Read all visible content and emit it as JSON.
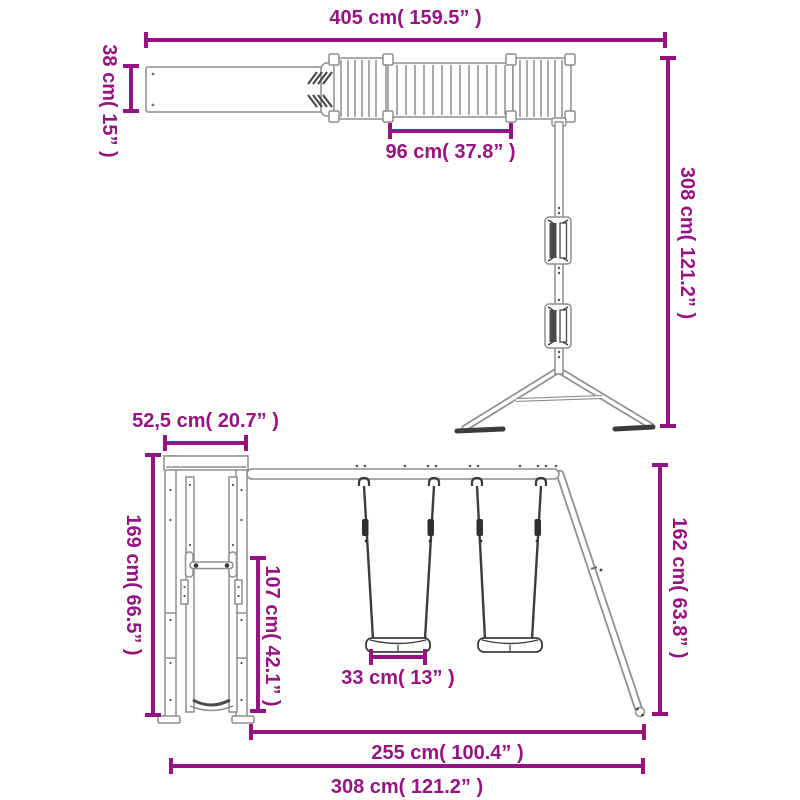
{
  "colors": {
    "dimension_accent": "#961482",
    "structure_line": "#8e8e8e",
    "structure_dark": "#3c3c3c",
    "background": "#ffffff"
  },
  "top_view": {
    "dimensions": {
      "total_length": "405 cm( 159.5” )",
      "platform_depth": "38 cm( 15” )",
      "bridge_length": "96 cm( 37.8” )",
      "frame_depth": "308 cm( 121.2” )"
    }
  },
  "front_view": {
    "dimensions": {
      "tower_width": "52,5 cm( 20.7” )",
      "tower_height": "169 cm( 66.5” )",
      "slide_length": "107 cm( 42.1” )",
      "swing_frame_height": "162 cm( 63.8” )",
      "seat_width": "33 cm( 13” )",
      "swing_span": "255 cm( 100.4” )",
      "total_width": "308 cm( 121.2” )"
    }
  }
}
